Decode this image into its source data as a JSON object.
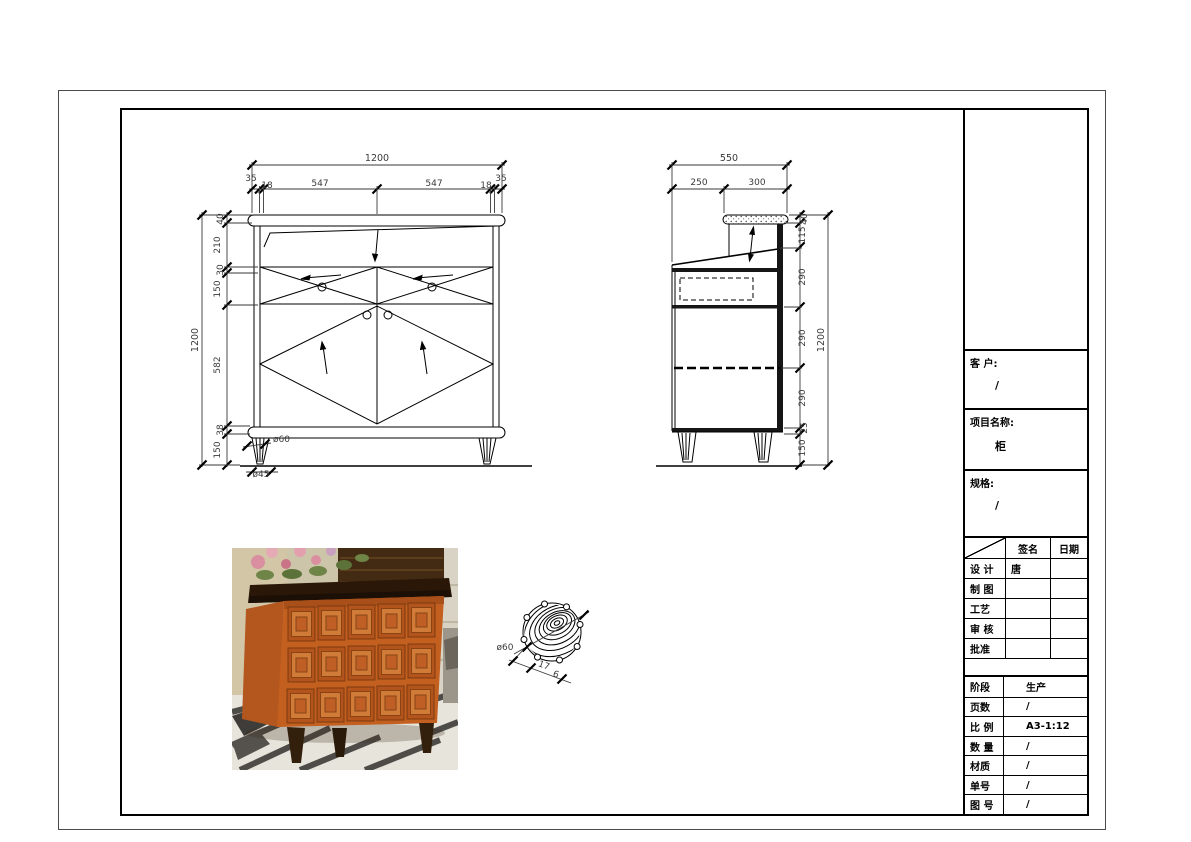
{
  "title_block": {
    "customer": {
      "label": "客 户:",
      "value": "/"
    },
    "project": {
      "label": "项目名称:",
      "value": "柜"
    },
    "spec": {
      "label": "规格:",
      "value": "/"
    },
    "sign_table": {
      "col_sign": "签名",
      "col_date": "日期",
      "rows": [
        {
          "label": "设 计",
          "sign": "唐",
          "date": ""
        },
        {
          "label": "制 图",
          "sign": "",
          "date": ""
        },
        {
          "label": "工艺",
          "sign": "",
          "date": ""
        },
        {
          "label": "审 核",
          "sign": "",
          "date": ""
        },
        {
          "label": "批准",
          "sign": "",
          "date": ""
        }
      ]
    },
    "info_table": {
      "rows": [
        {
          "label": "阶段",
          "value": "生产"
        },
        {
          "label": "页数",
          "value": "/"
        },
        {
          "label": "比 例",
          "value": "A3-1:12"
        },
        {
          "label": "数 量",
          "value": "/"
        },
        {
          "label": "材质",
          "value": "/"
        },
        {
          "label": "单号",
          "value": "/"
        },
        {
          "label": "图 号",
          "value": "/"
        }
      ]
    }
  },
  "front_view": {
    "dim_width": "1200",
    "top_dims": [
      "35",
      "18",
      "547",
      "547",
      "18",
      "35"
    ],
    "dim_height": "1200",
    "left_dims": [
      "40",
      "210",
      "30",
      "150",
      "582",
      "38",
      "150"
    ],
    "leg_top_dia": "ø60",
    "leg_bottom_dia": "ø45"
  },
  "side_view": {
    "dim_depth": "550",
    "top_dims": [
      "250",
      "300"
    ],
    "dim_height": "1200",
    "right_dims": [
      "40",
      "115",
      "290",
      "290",
      "290",
      "25",
      "150"
    ]
  },
  "detail_view": {
    "dia": "ø60",
    "dims": [
      "17",
      "6"
    ]
  }
}
